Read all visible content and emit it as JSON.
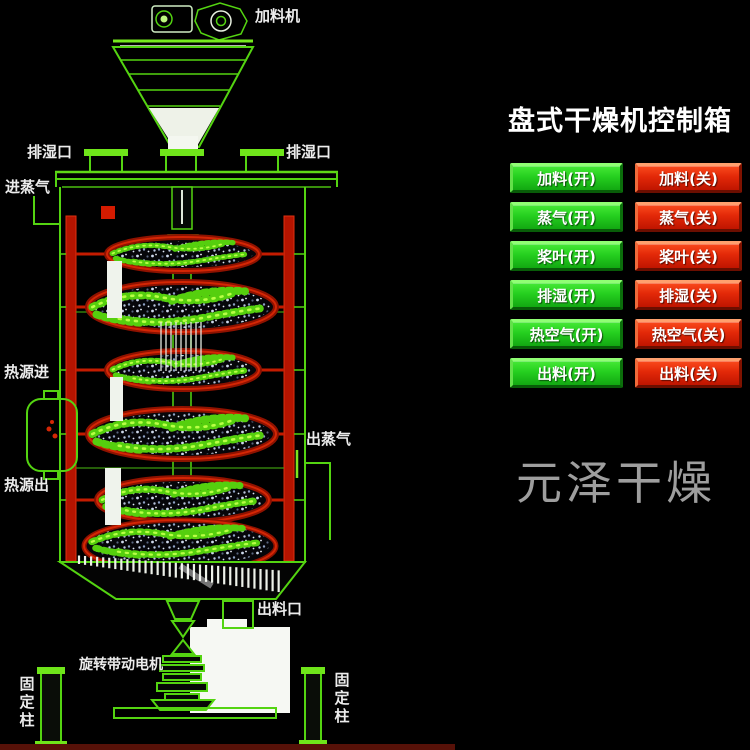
{
  "window": {
    "width": 750,
    "height": 750,
    "background": "#000000"
  },
  "control_panel": {
    "title": "盘式干燥机控制箱",
    "rows": [
      {
        "name": "feed",
        "on": "加料(开)",
        "off": "加料(关)"
      },
      {
        "name": "steam",
        "on": "蒸气(开)",
        "off": "蒸气(关)"
      },
      {
        "name": "paddle",
        "on": "桨叶(开)",
        "off": "桨叶(关)"
      },
      {
        "name": "dehumidify",
        "on": "排湿(开)",
        "off": "排湿(关)"
      },
      {
        "name": "hot-air",
        "on": "热空气(开)",
        "off": "热空气(关)"
      },
      {
        "name": "discharge",
        "on": "出料(开)",
        "off": "出料(关)"
      }
    ],
    "on_color": "#2ed42a",
    "off_color": "#e63313",
    "title_color": "#ffffff"
  },
  "diagram": {
    "labels": {
      "feeder": "加料机",
      "vent_left": "排湿口",
      "vent_right": "排湿口",
      "steam_in": "进蒸气",
      "heat_source_in": "热源进",
      "heat_source_out": "热源出",
      "steam_out": "出蒸气",
      "discharge_port": "出料口",
      "drive_motor": "旋转带动电机",
      "fixed_column_left": "固定柱",
      "fixed_column_right": "固定柱"
    },
    "line_color": "#54d411",
    "rail_color": "#c41b00",
    "label_color": "#ececec"
  },
  "watermark": {
    "text": "元泽干燥",
    "color": "#9e9e9e"
  }
}
